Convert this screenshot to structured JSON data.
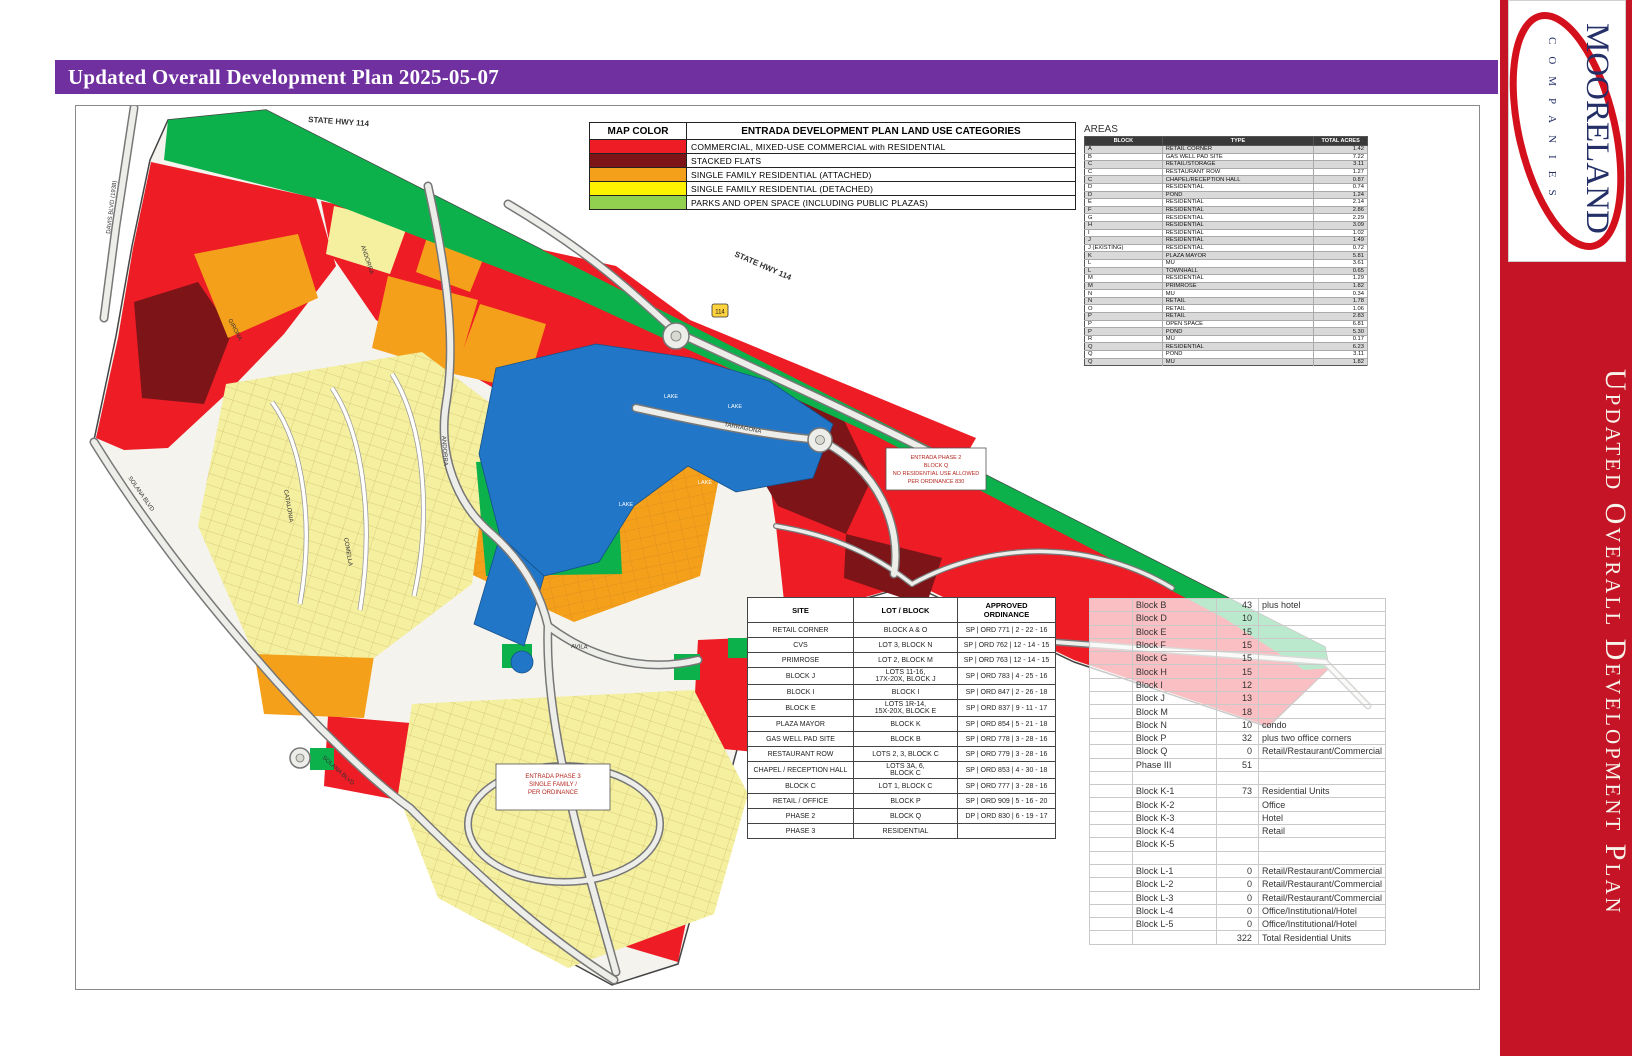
{
  "header": {
    "title": "Updated Overall Development Plan 2025-05-07"
  },
  "sidebar": {
    "logo_name": "MOORELAND",
    "logo_sub": "COMPANIES",
    "vertical_title": "Updated Overall Development Plan",
    "accent_color": "#C41425"
  },
  "legend": {
    "col_color": "MAP COLOR",
    "col_categories": "ENTRADA DEVELOPMENT PLAN LAND USE CATEGORIES",
    "items": [
      {
        "color": "#EE1C25",
        "label": "COMMERCIAL, MIXED-USE COMMERCIAL with RESIDENTIAL"
      },
      {
        "color": "#7D1418",
        "label": "STACKED FLATS"
      },
      {
        "color": "#F5A01B",
        "label": "SINGLE FAMILY RESIDENTIAL (ATTACHED)"
      },
      {
        "color": "#FFF200",
        "label": "SINGLE FAMILY RESIDENTIAL (DETACHED)"
      },
      {
        "color": "#92D050",
        "label": "PARKS AND OPEN SPACE (INCLUDING PUBLIC PLAZAS)"
      }
    ]
  },
  "areas_table": {
    "title": "AREAS",
    "headers": [
      "BLOCK",
      "TYPE",
      "TOTAL ACRES"
    ],
    "rows": [
      [
        "A",
        "RETAIL CORNER",
        "1.42"
      ],
      [
        "B",
        "GAS WELL PAD SITE",
        "7.22"
      ],
      [
        "C",
        "RETAIL/STORAGE",
        "3.11"
      ],
      [
        "C",
        "RESTAURANT ROW",
        "1.27"
      ],
      [
        "C",
        "CHAPEL/RECEPTION HALL",
        "0.87"
      ],
      [
        "D",
        "RESIDENTIAL",
        "0.74"
      ],
      [
        "D",
        "POND",
        "1.24"
      ],
      [
        "E",
        "RESIDENTIAL",
        "2.14"
      ],
      [
        "F",
        "RESIDENTIAL",
        "2.86"
      ],
      [
        "G",
        "RESIDENTIAL",
        "2.29"
      ],
      [
        "H",
        "RESIDENTIAL",
        "3.09"
      ],
      [
        "I",
        "RESIDENTIAL",
        "1.02"
      ],
      [
        "J",
        "RESIDENTIAL",
        "1.49"
      ],
      [
        "J (EXISTING)",
        "RESIDENTIAL",
        "0.72"
      ],
      [
        "K",
        "PLAZA MAYOR",
        "5.81"
      ],
      [
        "L",
        "MU",
        "3.61"
      ],
      [
        "L",
        "TOWNHALL",
        "0.65"
      ],
      [
        "M",
        "RESIDENTIAL",
        "1.29"
      ],
      [
        "M",
        "PRIMROSE",
        "1.82"
      ],
      [
        "N",
        "MU",
        "0.34"
      ],
      [
        "N",
        "RETAIL",
        "1.78"
      ],
      [
        "O",
        "RETAIL",
        "1.06"
      ],
      [
        "P",
        "RETAIL",
        "2.83"
      ],
      [
        "P",
        "OPEN SPACE",
        "6.81"
      ],
      [
        "P",
        "POND",
        "5.30"
      ],
      [
        "R",
        "MU",
        "0.17"
      ],
      [
        "Q",
        "RESIDENTIAL",
        "6.23"
      ],
      [
        "Q",
        "POND",
        "3.11"
      ],
      [
        "Q",
        "MU",
        "1.82"
      ]
    ]
  },
  "ordinance_table": {
    "headers": [
      "SITE",
      "LOT / BLOCK",
      "APPROVED\nORDINANCE"
    ],
    "rows": [
      [
        "RETAIL CORNER",
        "BLOCK A & O",
        "SP | ORD 771 | 2 - 22 - 16"
      ],
      [
        "CVS",
        "LOT 3, BLOCK N",
        "SP | ORD 762 | 12 - 14 - 15"
      ],
      [
        "PRIMROSE",
        "LOT 2, BLOCK M",
        "SP | ORD 763 | 12 - 14 - 15"
      ],
      [
        "BLOCK J",
        "LOTS 11-16,\n17X-20X, BLOCK J",
        "SP | ORD 783 | 4 - 25 - 16"
      ],
      [
        "BLOCK I",
        "BLOCK I",
        "SP | ORD 847 | 2 - 26 - 18"
      ],
      [
        "BLOCK E",
        "LOTS 1R-14,\n15X-20X, BLOCK E",
        "SP | ORD 837 | 9 - 11 - 17"
      ],
      [
        "PLAZA MAYOR",
        "BLOCK K",
        "SP | ORD 854 | 5 - 21 - 18"
      ],
      [
        "GAS WELL PAD SITE",
        "BLOCK B",
        "SP | ORD 778 | 3 - 28 - 16"
      ],
      [
        "RESTAURANT ROW",
        "LOTS 2, 3, BLOCK C",
        "SP | ORD 779 | 3 - 28 - 16"
      ],
      [
        "CHAPEL / RECEPTION HALL",
        "LOTS 3A, 6,\nBLOCK C",
        "SP | ORD 853 | 4 - 30 - 18"
      ],
      [
        "BLOCK C",
        "LOT 1, BLOCK C",
        "SP | ORD 777 | 3 - 28 - 16"
      ],
      [
        "RETAIL / OFFICE",
        "BLOCK P",
        "SP | ORD 909 | 5 - 16 - 20"
      ],
      [
        "PHASE 2",
        "BLOCK Q",
        "DP | ORD 830 | 6 - 19 - 17"
      ],
      [
        "PHASE 3",
        "RESIDENTIAL",
        ""
      ]
    ]
  },
  "block_table": {
    "rows": [
      [
        "Block B",
        "43",
        "plus hotel"
      ],
      [
        "Block D",
        "10",
        ""
      ],
      [
        "Block E",
        "15",
        ""
      ],
      [
        "Block F",
        "15",
        ""
      ],
      [
        "Block G",
        "15",
        ""
      ],
      [
        "Block H",
        "15",
        ""
      ],
      [
        "Block I",
        "12",
        ""
      ],
      [
        "Block J",
        "13",
        ""
      ],
      [
        "Block M",
        "18",
        ""
      ],
      [
        "Block N",
        "10",
        "condo"
      ],
      [
        "Block P",
        "32",
        "plus two office corners"
      ],
      [
        "Block Q",
        "0",
        "Retail/Restaurant/Commercial"
      ],
      [
        "Phase III",
        "51",
        ""
      ],
      [
        "",
        "",
        ""
      ],
      [
        "Block K-1",
        "73",
        "Residential Units"
      ],
      [
        "Block K-2",
        "",
        "Office"
      ],
      [
        "Block K-3",
        "",
        "Hotel"
      ],
      [
        "Block K-4",
        "",
        "Retail"
      ],
      [
        "Block K-5",
        "",
        ""
      ],
      [
        "",
        "",
        ""
      ],
      [
        "Block L-1",
        "0",
        "Retail/Restaurant/Commercial"
      ],
      [
        "Block L-2",
        "0",
        "Retail/Restaurant/Commercial"
      ],
      [
        "Block L-3",
        "0",
        "Retail/Restaurant/Commercial"
      ],
      [
        "Block L-4",
        "0",
        "Office/Institutional/Hotel"
      ],
      [
        "Block L-5",
        "0",
        "Office/Institutional/Hotel"
      ],
      [
        "",
        "322",
        "Total Residential Units"
      ]
    ]
  },
  "map": {
    "labels": {
      "hwy114": "STATE HWY 114",
      "davis": "DAVIS BLVD (1938)",
      "solana": "SOLANA BLVD",
      "tarragona": "TARRAGONA",
      "andorra": "ANDORRA",
      "catalonia": "CATALONIA",
      "comella": "COMELLA",
      "girona": "GIRONA",
      "avila": "AVILA",
      "lake": "LAKE",
      "toll": "114"
    },
    "notes": {
      "phase2": {
        "lines": [
          "ENTRADA PHASE 2",
          "BLOCK Q",
          "NO RESIDENTIAL USE ALLOWED",
          "PER ORDINANCE 830"
        ]
      },
      "phase3": {
        "lines": [
          "ENTRADA PHASE 3",
          "SINGLE FAMILY /",
          "PER ORDINANCE"
        ]
      }
    }
  }
}
